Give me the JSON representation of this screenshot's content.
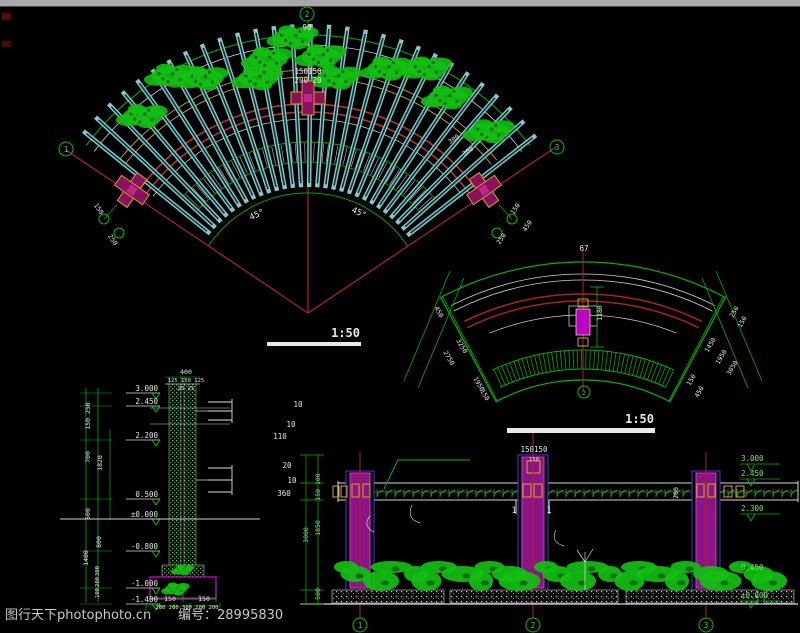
{
  "watermark": {
    "site": "图行天下photophoto.cn",
    "number": "编号：28995830"
  },
  "fan": {
    "bubble_top": "2",
    "bubble_left": "1",
    "bubble_right": "3",
    "angle_total": "90",
    "angle_left": "45°",
    "angle_right": "45°",
    "center_label_line1": "150150",
    "center_label_line2": "200 20",
    "end_dims_left": [
      "150",
      "250"
    ],
    "end_dims_right": [
      "150",
      "250",
      "450"
    ],
    "radial_dims": [
      "300",
      "300"
    ],
    "scale": "1:50"
  },
  "curve": {
    "top_label": "67",
    "vertical_dim": "1180",
    "left_dims": [
      "450",
      "3250",
      "2750",
      "1950",
      "150"
    ],
    "right_dims": [
      "250",
      "150",
      "1450",
      "1950",
      "3050",
      "150",
      "450"
    ],
    "bubble": "2"
  },
  "section": {
    "top_dims": [
      "400",
      "125 150 125",
      "25 25"
    ],
    "levels": [
      "3.000",
      "2.450",
      "2.200",
      "0.500",
      "±0.000",
      "-0.800",
      "-1.000",
      "-1.400"
    ],
    "side_dims": [
      "150 250",
      "700",
      "1820",
      "500",
      "800",
      "1400",
      "300",
      "200",
      "100"
    ],
    "bottom_dims": [
      "150",
      "150",
      "200 200 300 200 200"
    ],
    "notes": [
      "10",
      "10",
      "110",
      "20",
      "10",
      "360"
    ]
  },
  "elevation": {
    "scale": "1:50",
    "levels": [
      "3.000",
      "2.450",
      "2.300",
      "0.450",
      "±0.000"
    ],
    "left_dims": [
      "150 100",
      "3000",
      "1850",
      "500"
    ],
    "center_label": "150150",
    "center_sub": "150",
    "section_marks": [
      "1",
      "1"
    ],
    "beam_dim": "200",
    "bubbles": [
      "1",
      "2",
      "3"
    ]
  }
}
